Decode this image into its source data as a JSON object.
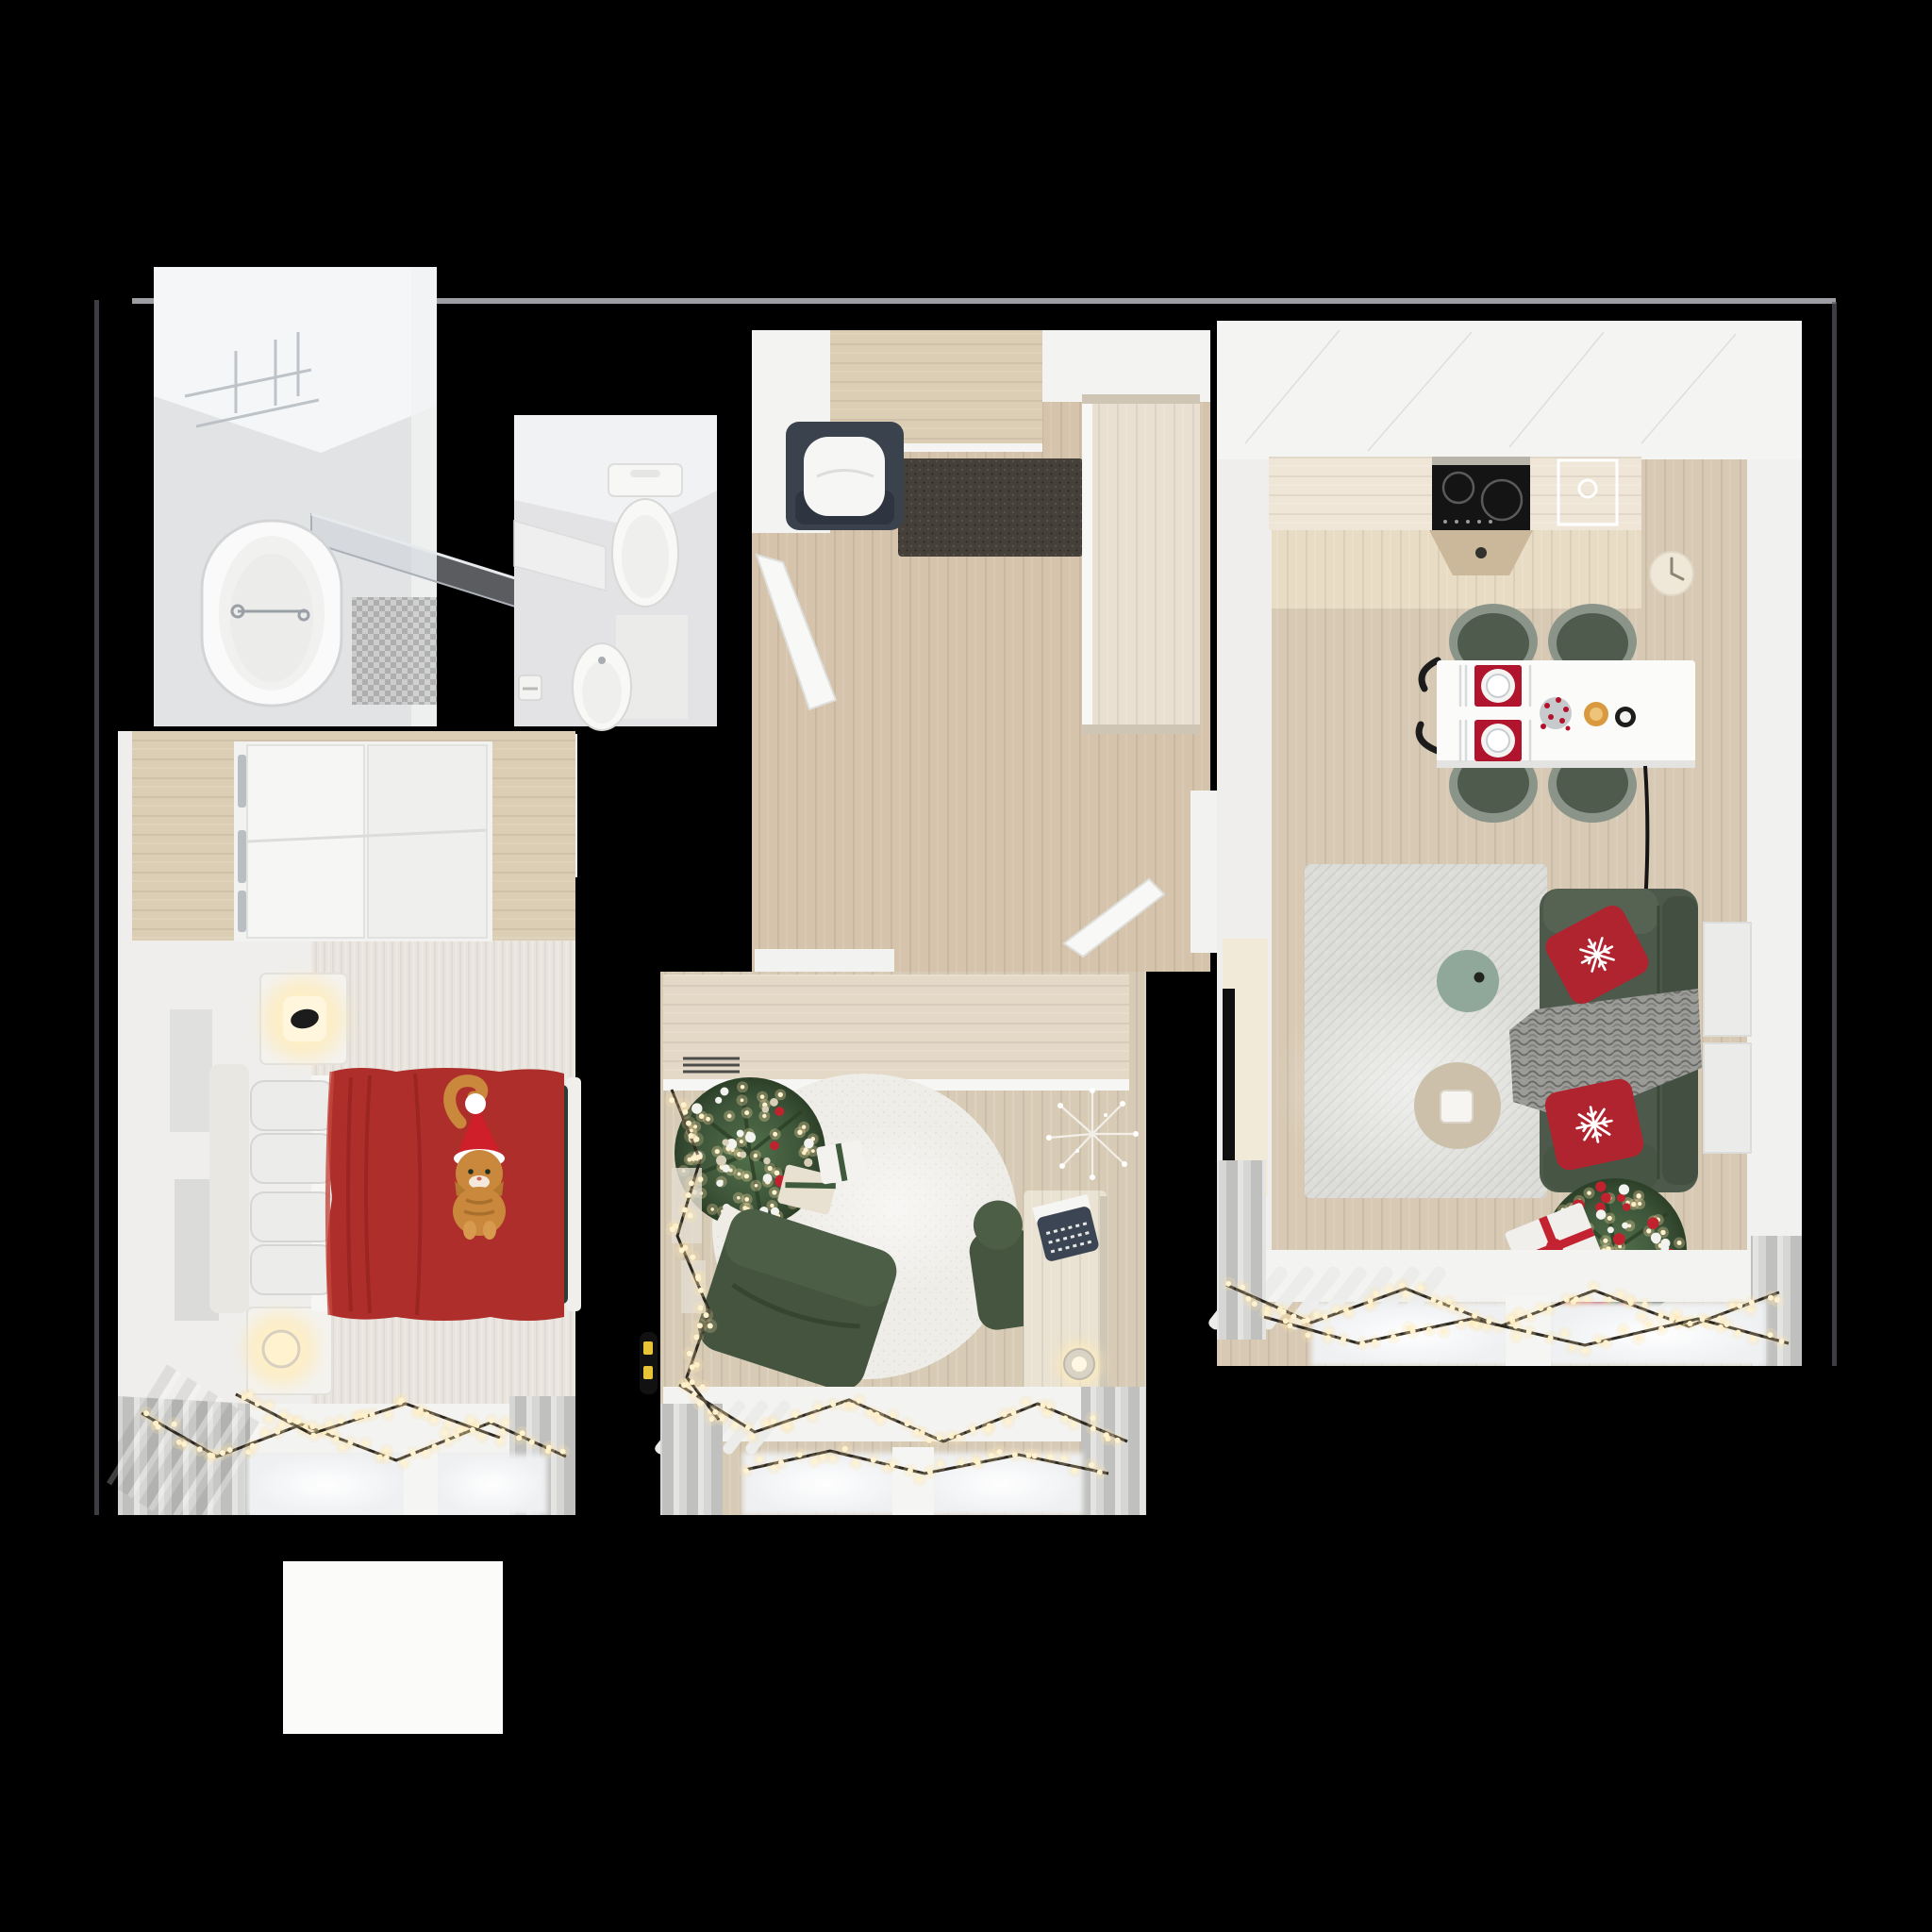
{
  "scene": {
    "kind": "3d-floor-plan-top-down-render",
    "theme": "apartment decorated for christmas",
    "text_content": "none",
    "background": "#000000"
  },
  "colors": {
    "bg": "#000000",
    "line": "#b7bac0",
    "edge": "#55585c",
    "white": "#f2f2f1",
    "wood": "#d5c3ab",
    "woodlight": "#dccdb5",
    "pale": "#eceae5",
    "bath": "#e2e3e5",
    "tile": "#a0a0a0",
    "mat": "#45403a",
    "bench": "#3a424e",
    "wardrobe": "#e9e0d1",
    "counter": "#efe6d7",
    "splash": "#e8dcc5",
    "stove": "#141414",
    "table": "#fbfbfa",
    "chairgreen": "#4e5b4d",
    "chairlight": "#60705d",
    "placemat": "#b1152e",
    "red": "#b02430",
    "sofa": "#4c594b",
    "throw": "#9b9b97",
    "ruglive": "#dcdcd8",
    "ruground": "#efede8",
    "sage": "#8fa89a",
    "beige": "#ccc0aa",
    "tree": "#3d5439",
    "light": "#ffe2a8",
    "wire": "#2c2820",
    "blanket": "#ad2e2a",
    "cat": "#c9883c",
    "hat": "#cf1f2b",
    "cream": "#f2ead9",
    "desk": "#eae2d2",
    "type": "#3c4553",
    "curtain": "#d6d6d4",
    "sill": "#f3f3f1",
    "frame": "#ebebe9",
    "stand": "#f4f2ee",
    "glow": "#fff3cf"
  },
  "rooms": [
    {
      "id": "bathroom",
      "name": "Bathroom",
      "furniture": [
        "bathtub",
        "chrome-faucet",
        "glass-shower-screen",
        "towel-rack",
        "tiled-shower-mat"
      ]
    },
    {
      "id": "wc",
      "name": "Toilet room",
      "furniture": [
        "toilet",
        "bidet",
        "corner-shelf",
        "floor-mat",
        "paper-holder"
      ]
    },
    {
      "id": "hallway",
      "name": "Entry hallway",
      "furniture": [
        "entry-bench-navy",
        "white-cushion",
        "doormat",
        "tall-wardrobe-cabinet",
        "open-door-to-wc",
        "open-door-to-living-room",
        "entry-threshold"
      ]
    },
    {
      "id": "kitchen-living",
      "name": "Kitchen / living room",
      "furniture": [
        "kitchen-counter",
        "induction-cooktop",
        "sink",
        "cooker-hood",
        "wall-clock",
        "dining-table",
        "four-green-dining-chairs",
        "red-placemats-with-plates",
        "table-decor",
        "black-floor-lamp",
        "large-area-rug",
        "sage-coffee-table",
        "beige-side-table",
        "tv-panel",
        "green-sofa",
        "red-snowflake-pillows",
        "gray-knit-throw",
        "christmas-tree",
        "gift-boxes",
        "two-wall-frames",
        "radiator-fins",
        "string-light-garland",
        "curtains",
        "windows"
      ]
    },
    {
      "id": "bedroom",
      "name": "Bedroom",
      "furniture": [
        "wardrobe-with-open-doors",
        "bed",
        "headboard",
        "pillows",
        "red-blanket",
        "ginger-cat-with-santa-hat",
        "cube-lamp-nightstand",
        "round-lamp-nightstand",
        "dark-green-footboard-bench",
        "wall-art",
        "string-light-garland",
        "curtains",
        "windows"
      ]
    },
    {
      "id": "kids-room",
      "name": "Kids room / study",
      "furniture": [
        "wood-sideboard-with-vent-grille",
        "round-cream-rug",
        "christmas-tree-with-lights",
        "gift-boxes",
        "green-lounge-chair",
        "green-desk-chair",
        "desk",
        "toy-typewriter",
        "desk-cup",
        "sparkly-twig-decor",
        "two-wall-frames",
        "wall-device-yellow-stripes",
        "string-light-garland",
        "curtains",
        "windows",
        "radiator-fins"
      ]
    },
    {
      "id": "balcony",
      "name": "Balcony slab",
      "furniture": []
    }
  ],
  "lights": {
    "garland_color": "#ffe2a8",
    "approx_bulb_count": 320,
    "tree_light_clusters": 2
  }
}
